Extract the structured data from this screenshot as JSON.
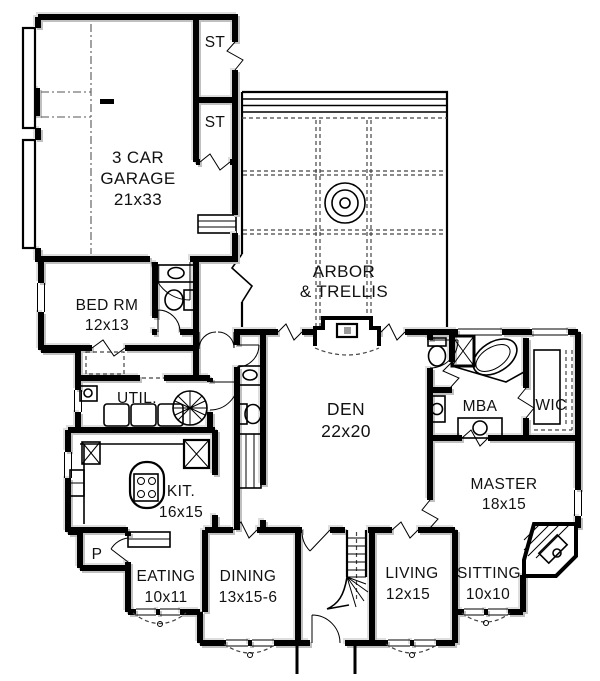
{
  "colors": {
    "wall": "#000000",
    "shadow": "#c0c0c0",
    "bg": "#ffffff",
    "text": "#111111"
  },
  "rooms": {
    "garage": {
      "l1": "3 CAR",
      "l2": "GARAGE",
      "l3": "21x33"
    },
    "st1": {
      "label": "ST"
    },
    "st2": {
      "label": "ST"
    },
    "arbor": {
      "l1": "ARBOR",
      "l2": "& TRELLIS"
    },
    "bedrm": {
      "l1": "BED RM",
      "l2": "12x13"
    },
    "util": {
      "label": "UTIL."
    },
    "den": {
      "l1": "DEN",
      "l2": "22x20"
    },
    "mba": {
      "label": "MBA"
    },
    "wic": {
      "label": "WIC"
    },
    "master": {
      "l1": "MASTER",
      "l2": "18x15"
    },
    "kitchen": {
      "l1": "KIT.",
      "l2": "16x15"
    },
    "pantry": {
      "label": "P"
    },
    "eating": {
      "l1": "EATING",
      "l2": "10x11"
    },
    "dining": {
      "l1": "DINING",
      "l2": "13x15-6"
    },
    "living": {
      "l1": "LIVING",
      "l2": "12x15"
    },
    "sitting": {
      "l1": "SITTING",
      "l2": "10x10"
    }
  }
}
